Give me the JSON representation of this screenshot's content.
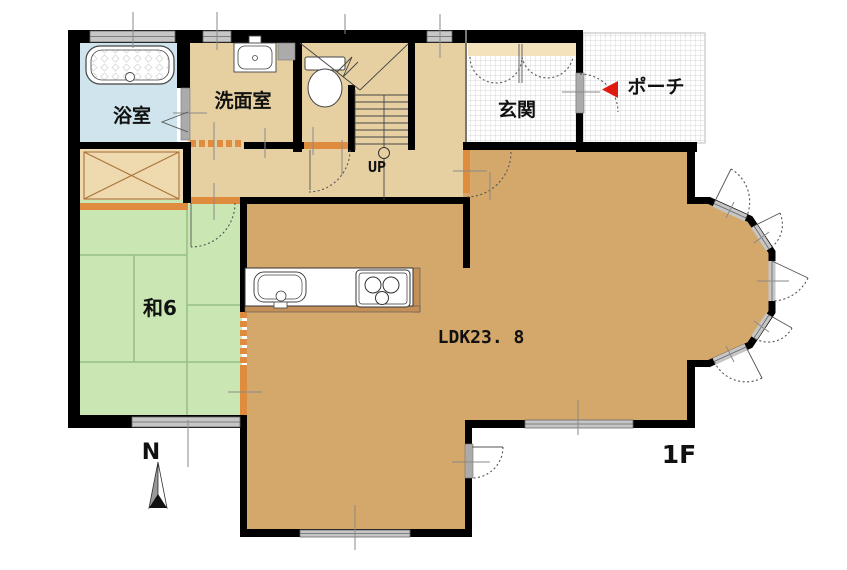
{
  "floorplan": {
    "rooms": {
      "bathroom": "浴室",
      "washroom": "洗面室",
      "entrance": "玄関",
      "porch": "ポーチ",
      "japanese_room": "和6",
      "ldk": "LDK23. 8"
    },
    "labels": {
      "stairs_up": "UP",
      "floor": "1F",
      "compass_north": "N"
    },
    "colors": {
      "wall": "#000000",
      "hall_floor": "#E6D0A2",
      "ldk_floor": "#D4A76A",
      "japanese_room_floor": "#C9E6B3",
      "tatami_line": "#96BF85",
      "bathroom_floor": "#CFE4EC",
      "closet_floor": "#EFD9AE",
      "closet_line": "#A8743C",
      "shoe_cabinet": "#F3E2BC",
      "threshold_orange": "#DF8C3E",
      "window_gray": "#C6C6C6",
      "door_gray": "#ABABAB",
      "entry_arrow_red": "#DE1A10"
    }
  }
}
